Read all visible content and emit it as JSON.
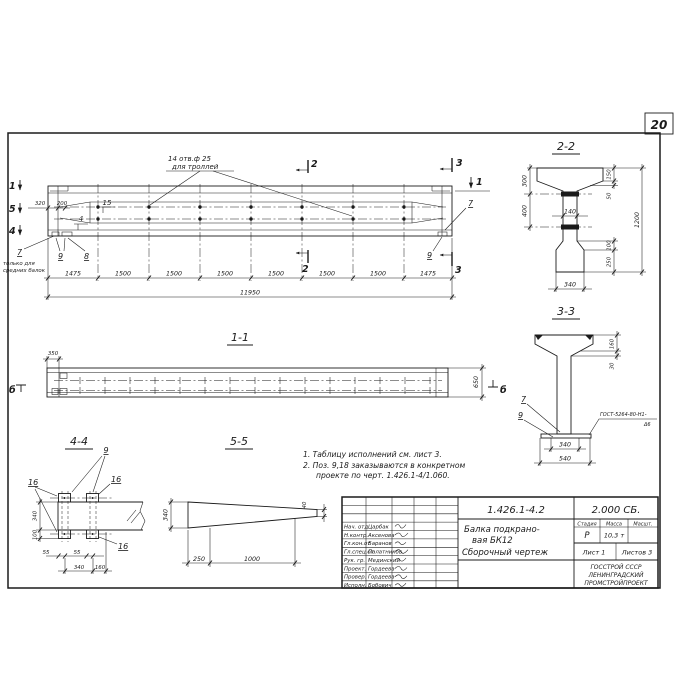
{
  "page": {
    "sheet_number": "20"
  },
  "elevation": {
    "hole_callout_line1": "14 отв.ф 25",
    "hole_callout_line2": "для троллей",
    "note_line1": "только для",
    "note_line2": "средних балок",
    "marks": {
      "m1_left": "1",
      "m5_left": "5",
      "m4_left": "4",
      "m2_top": "2",
      "m2_bot": "2",
      "m3_top": "3",
      "m3_bot": "3",
      "m1_right": "1"
    },
    "pos": {
      "p15": "15",
      "p4": "4",
      "p7_left": "7",
      "p9_left": "9",
      "p8": "8",
      "p7_right": "7",
      "p9_right": "9"
    },
    "dims": {
      "d320": "320",
      "d200": "200",
      "chain": [
        "1475",
        "1500",
        "1500",
        "1500",
        "1500",
        "1500",
        "1500",
        "1475"
      ],
      "total": "11950"
    }
  },
  "section_1_1": {
    "title": "1-1",
    "dim_350": "350",
    "dim_650": "650",
    "mark_b_left": "б",
    "mark_b_right": "б"
  },
  "section_2_2": {
    "title": "2-2",
    "dim_300": "300",
    "dim_400": "400",
    "dim_150": "150",
    "dim_50": "50",
    "dim_1200": "1200",
    "dim_100": "100",
    "dim_250": "250",
    "dim_140": "140",
    "dim_340": "340"
  },
  "section_3_3": {
    "title": "3-3",
    "dim_160": "160",
    "dim_30": "30",
    "dim_340": "340",
    "dim_540": "540",
    "pos_7": "7",
    "pos_9": "9",
    "weld_line1": "ГОСТ-5264-80-Н1-",
    "weld_line2": "Δ6"
  },
  "view_4_4": {
    "title": "4-4",
    "pos_9": "9",
    "pos_16_left": "16",
    "pos_16_right": "16",
    "pos_16_bottom": "16",
    "dim_340_v": "340",
    "dim_100": "100",
    "dim_55_a": "55",
    "dim_55_b": "55",
    "dim_340_h": "340",
    "dim_160": "160"
  },
  "view_5_5": {
    "title": "5-5",
    "dim_340": "340",
    "dim_250": "250",
    "dim_1000": "1000",
    "dim_40": "40"
  },
  "notes": {
    "line1": "1. Таблицу исполнений см. лист 3.",
    "line2": "2. Поз. 9,18 заказываются в конкретном",
    "line3": "проекте по черт. 1.426.1-4/1.060."
  },
  "title_block": {
    "doc_number": "1.426.1-4.2",
    "doc_code": "2.000 СБ.",
    "title_line1": "Балка подкрано-",
    "title_line2": "вая БК12",
    "title_line3": "Сборочный чертеж",
    "stage_header": "Стадия",
    "mass_header": "Масса",
    "scale_header": "Масшт.",
    "stage_value": "Р",
    "mass_value": "10,3 т",
    "sheet_label": "Лист 1",
    "sheets_label": "Листов 3",
    "org_line1": "ГОССТРОЙ СССР",
    "org_line2": "ЛЕНИНГРАДСКИЙ",
    "org_line3": "ПРОМСТРОЙПРОЕКТ",
    "signatures": [
      {
        "role": "Нач. отд",
        "name": "Царбак"
      },
      {
        "role": "Н.контр.",
        "name": "Аксенова"
      },
      {
        "role": "Гл.кон.от",
        "name": "Баранов"
      },
      {
        "role": "Гл.спец.от",
        "name": "Палатников"
      },
      {
        "role": "Рук. гр.",
        "name": "Мединский"
      },
      {
        "role": "Проект.",
        "name": "Гордеева"
      },
      {
        "role": "Провер.",
        "name": "Гордеева"
      },
      {
        "role": "Исполн.",
        "name": "Бобович"
      }
    ]
  }
}
